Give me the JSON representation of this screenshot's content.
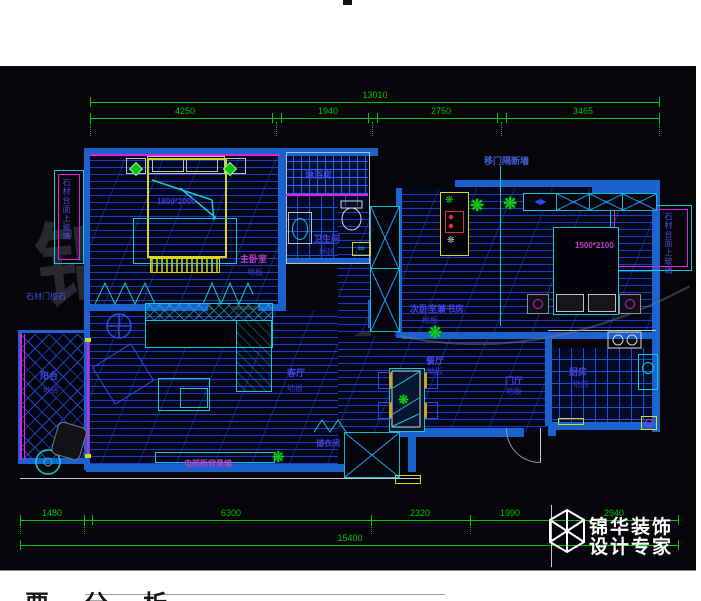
{
  "canvas": {
    "footer_partial_text": "要分析"
  },
  "watermark": {
    "chars": [
      "锦",
      "华",
      "装",
      "饰"
    ]
  },
  "logo": {
    "brand": "锦华装饰",
    "tagline": "设计专家"
  },
  "dims": {
    "top": {
      "total": "13010",
      "segs": [
        "4250",
        "1940",
        "2750",
        "3465"
      ]
    },
    "bottom": {
      "total": "15400",
      "segs": [
        "1480",
        "6300",
        "2320",
        "1990",
        "2940"
      ]
    }
  },
  "rooms": {
    "master": {
      "name": "主卧室",
      "floor": "地板"
    },
    "bath": {
      "name": "卫生间",
      "floor": "地砖"
    },
    "shower": {
      "name": "淋浴房"
    },
    "study": {
      "name": "次卧室兼书房",
      "floor": "地板"
    },
    "living": {
      "name": "客厅",
      "floor": "地板"
    },
    "dining": {
      "name": "餐厅",
      "floor": "地板"
    },
    "hall": {
      "name": "门厅",
      "floor": "地板"
    },
    "kitchen": {
      "name": "厨房",
      "floor": "地砖"
    },
    "balcony": {
      "name": "阳台",
      "floor": "地砖"
    },
    "cloak": {
      "name": "储衣间"
    }
  },
  "annotations": {
    "partition": "移门隔断墙",
    "stone_glass_left": "石材台面上玻璃",
    "stone_glass_right": "石材台面上玻璃",
    "threshold": "石材门槛石",
    "tv_wall": "电视柜背景墙",
    "master_bed": "1800*2000",
    "second_bed": "1500*2100"
  },
  "colors": {
    "dimension_green": "#00c800",
    "wall_blue": "#1a63cf",
    "furniture_cyan": "#15c8d8",
    "window_magenta": "#e020e0",
    "highlight_yellow": "#d8d818",
    "label_blue": "#4343e0",
    "label_magenta": "#c23cc2"
  }
}
